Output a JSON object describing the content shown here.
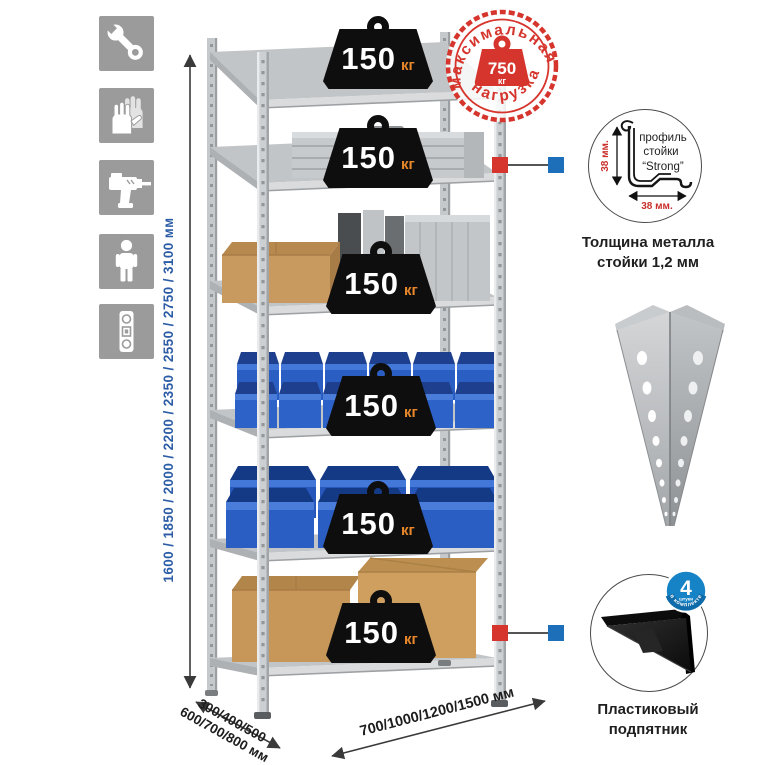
{
  "rack": {
    "badge_value": "150",
    "badge_unit": "кг",
    "shelf_count": 6
  },
  "stamp": {
    "arc_top": "максимальная",
    "arc_bottom": "нагрузка",
    "value": "750",
    "unit": "кг"
  },
  "dimensions": {
    "height": "1600 / 1850 / 2000 / 2200 / 2350 / 2550 / 2750 / 3100 мм",
    "depth_line1": "300/400/500",
    "depth_line2": "600/700/800 мм",
    "width": "700/1000/1200/1500 мм"
  },
  "profile_detail": {
    "line1": "профиль",
    "line2": "стойки",
    "line3": "“Strong”",
    "dim_vertical": "38 мм.",
    "dim_horizontal": "38 мм.",
    "caption_line1": "Толщина металла",
    "caption_line2": "стойки 1,2 мм"
  },
  "foot_detail": {
    "badge_number": "4",
    "badge_small": "штуки",
    "badge_arc": "в комплекте",
    "caption_line1": "Пластиковый",
    "caption_line2": "подпятник"
  },
  "icons": {
    "items": [
      "wrench-icon",
      "gloves-icon",
      "drill-icon",
      "person-icon",
      "level-icon"
    ]
  },
  "colors": {
    "accent_red": "#d5352c",
    "dimension_blue": "#2b5ca5",
    "badge_unit_orange": "#e8872b",
    "bin_blue": "#2a5ec2",
    "connector_blue": "#1c6fb8",
    "icon_gray": "#9b9b9b"
  }
}
